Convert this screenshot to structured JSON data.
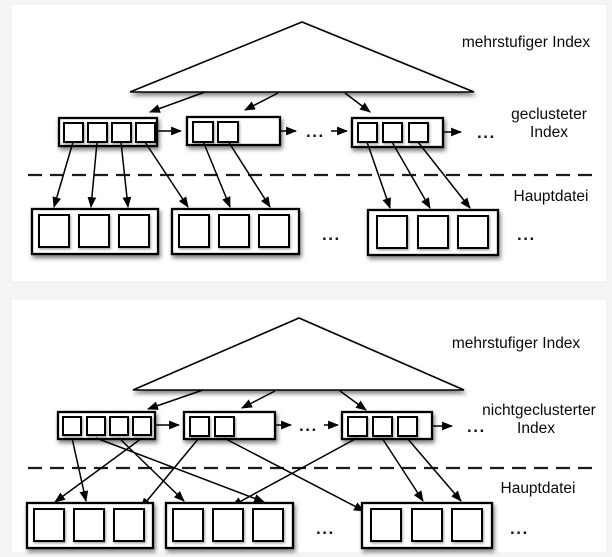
{
  "colors": {
    "background": "#f5f5f6",
    "panel": "#ffffff",
    "line": "#000000",
    "text": "#0a0a0a"
  },
  "diagrams": [
    {
      "title_label": "mehrstufiger Index",
      "index_type_label_line1": "geclusteter",
      "index_type_label_line2": "Index",
      "file_label": "Hauptdatei",
      "ellipsis": "...",
      "index_nodes_entry_counts": [
        4,
        2,
        3
      ],
      "file_blocks_record_counts": [
        3,
        3,
        3
      ]
    },
    {
      "title_label": "mehrstufiger Index",
      "index_type_label_line1": "nichtgeclusterter",
      "index_type_label_line2": "Index",
      "file_label": "Hauptdatei",
      "ellipsis": "...",
      "index_nodes_entry_counts": [
        4,
        2,
        3
      ],
      "file_blocks_record_counts": [
        3,
        3,
        3
      ]
    }
  ]
}
